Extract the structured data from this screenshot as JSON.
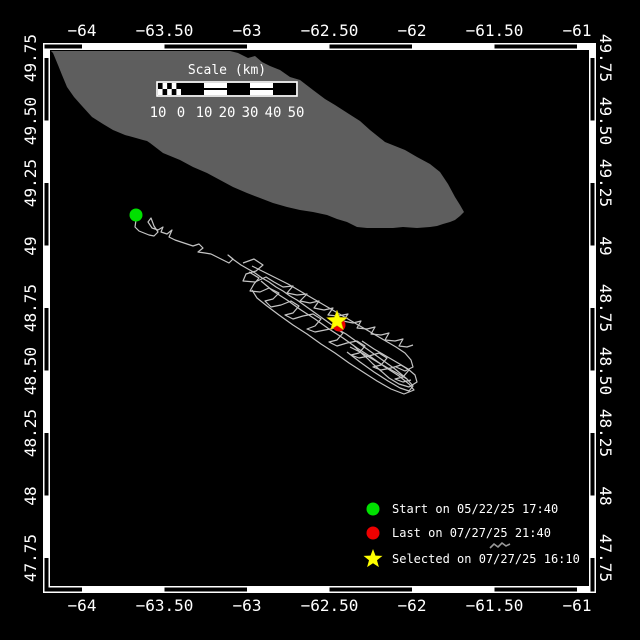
{
  "colors": {
    "background": "#000000",
    "frame": "#ffffff",
    "land": "#5e5e5e",
    "track": "#c4c4c4",
    "islet": "#9a9a9a",
    "start": "#00e000",
    "last": "#ee0000",
    "selected": "#ffff00",
    "text": "#ffffff"
  },
  "axes": {
    "x_ticks": [
      {
        "label": "−64",
        "lon": -64
      },
      {
        "label": "−63.50",
        "lon": -63.5
      },
      {
        "label": "−63",
        "lon": -63
      },
      {
        "label": "−62.50",
        "lon": -62.5
      },
      {
        "label": "−62",
        "lon": -62
      },
      {
        "label": "−61.50",
        "lon": -61.5
      },
      {
        "label": "−61",
        "lon": -61
      }
    ],
    "y_ticks": [
      {
        "label": "49.75",
        "lat": 49.75
      },
      {
        "label": "49.50",
        "lat": 49.5
      },
      {
        "label": "49.25",
        "lat": 49.25
      },
      {
        "label": "49",
        "lat": 49.0
      },
      {
        "label": "48.75",
        "lat": 48.75
      },
      {
        "label": "48.50",
        "lat": 48.5
      },
      {
        "label": "48.25",
        "lat": 48.25
      },
      {
        "label": "48",
        "lat": 48.0
      },
      {
        "label": "47.75",
        "lat": 47.75
      }
    ]
  },
  "scalebar": {
    "title": "Scale (km)",
    "tick_labels": [
      "10",
      "0",
      "10",
      "20",
      "30",
      "40",
      "50"
    ],
    "km_per_segment": 10
  },
  "legend": [
    {
      "symbol": "circle",
      "color": "#00e000",
      "label": "Start on 05/22/25 17:40"
    },
    {
      "symbol": "circle",
      "color": "#ee0000",
      "label": "Last on 07/27/25 21:40"
    },
    {
      "symbol": "star",
      "color": "#ffff00",
      "label": "Selected on 07/27/25 16:10"
    }
  ],
  "markers": {
    "start": {
      "x": 136,
      "y": 215,
      "r": 6.5,
      "lon": -63.67,
      "lat": 49.12
    },
    "last": {
      "x": 339,
      "y": 325,
      "r": 6.5,
      "lon": -62.45,
      "lat": 48.68
    },
    "selected": {
      "x": 337,
      "y": 321,
      "r": 11,
      "lon": -62.46,
      "lat": 48.7
    }
  },
  "map": {
    "lon_range": [
      -64.25,
      -60.93
    ],
    "lat_range": [
      47.63,
      49.79
    ],
    "land_polygon": [
      [
        51,
        51
      ],
      [
        230,
        51
      ],
      [
        238,
        53
      ],
      [
        248,
        58
      ],
      [
        255,
        56
      ],
      [
        262,
        62
      ],
      [
        270,
        66
      ],
      [
        280,
        70
      ],
      [
        290,
        77
      ],
      [
        300,
        80
      ],
      [
        313,
        90
      ],
      [
        325,
        99
      ],
      [
        335,
        105
      ],
      [
        349,
        114
      ],
      [
        360,
        121
      ],
      [
        370,
        130
      ],
      [
        385,
        142
      ],
      [
        395,
        146
      ],
      [
        405,
        150
      ],
      [
        417,
        157
      ],
      [
        430,
        164
      ],
      [
        440,
        172
      ],
      [
        448,
        184
      ],
      [
        455,
        197
      ],
      [
        460,
        205
      ],
      [
        464,
        212
      ],
      [
        460,
        216
      ],
      [
        455,
        220
      ],
      [
        450,
        222
      ],
      [
        443,
        224
      ],
      [
        437,
        226
      ],
      [
        430,
        227
      ],
      [
        417,
        228
      ],
      [
        403,
        227
      ],
      [
        393,
        228
      ],
      [
        380,
        228
      ],
      [
        367,
        228
      ],
      [
        357,
        227
      ],
      [
        347,
        222
      ],
      [
        337,
        219
      ],
      [
        327,
        215
      ],
      [
        313,
        212
      ],
      [
        300,
        210
      ],
      [
        287,
        207
      ],
      [
        273,
        203
      ],
      [
        260,
        198
      ],
      [
        247,
        193
      ],
      [
        233,
        187
      ],
      [
        220,
        180
      ],
      [
        207,
        173
      ],
      [
        193,
        167
      ],
      [
        180,
        160
      ],
      [
        163,
        153
      ],
      [
        150,
        143
      ],
      [
        147,
        141
      ],
      [
        143,
        140
      ],
      [
        136,
        138
      ],
      [
        125,
        135
      ],
      [
        113,
        130
      ],
      [
        103,
        124
      ],
      [
        92,
        117
      ],
      [
        82,
        106
      ],
      [
        74,
        97
      ],
      [
        67,
        87
      ],
      [
        62,
        75
      ],
      [
        58,
        65
      ],
      [
        53,
        53
      ]
    ],
    "islet_path": [
      [
        490,
        548
      ],
      [
        494,
        544
      ],
      [
        498,
        547
      ],
      [
        502,
        543
      ],
      [
        506,
        546
      ],
      [
        510,
        544
      ]
    ]
  },
  "track": {
    "segments": [
      [
        136,
        220,
        135,
        227,
        139,
        231,
        144,
        233,
        149,
        235,
        154,
        236,
        158,
        232,
        154,
        226,
        151,
        218,
        148,
        222,
        152,
        228,
        158,
        230,
        163,
        227,
        161,
        232,
        167,
        234,
        172,
        230,
        169,
        237,
        175,
        240,
        181,
        242,
        187,
        244,
        193,
        246,
        199,
        244,
        203,
        248,
        198,
        252,
        205,
        253,
        211,
        254,
        217,
        257,
        223,
        260,
        229,
        263,
        233,
        259,
        228,
        255,
        234,
        260,
        241,
        265,
        248,
        269,
        255,
        273,
        262,
        278,
        269,
        282,
        276,
        287,
        283,
        291,
        290,
        296,
        297,
        300,
        304,
        305,
        311,
        310,
        318,
        315,
        325,
        320,
        332,
        325,
        339,
        330,
        346,
        334,
        353,
        339,
        360,
        344,
        367,
        349,
        374,
        354,
        381,
        359,
        388,
        364,
        395,
        369,
        401,
        374,
        407,
        379
      ],
      [
        243,
        263,
        254,
        259,
        263,
        265,
        256,
        271,
        246,
        274,
        243,
        281,
        255,
        282,
        266,
        277,
        274,
        282,
        283,
        287,
        293,
        286,
        287,
        293,
        297,
        295,
        307,
        294,
        300,
        301,
        310,
        303,
        319,
        301,
        314,
        308,
        324,
        310,
        333,
        308,
        328,
        315,
        338,
        316,
        348,
        314,
        343,
        321,
        353,
        323,
        361,
        321,
        357,
        328,
        367,
        329,
        375,
        327,
        371,
        334,
        381,
        335,
        389,
        333,
        385,
        340,
        395,
        341,
        403,
        339,
        399,
        346,
        407,
        347,
        413,
        345
      ],
      [
        249,
        272,
        259,
        278,
        254,
        284,
        250,
        291,
        260,
        292,
        269,
        288,
        279,
        293,
        273,
        299,
        265,
        301,
        271,
        307,
        281,
        305,
        291,
        301,
        299,
        306,
        293,
        313,
        285,
        315,
        293,
        319,
        303,
        316,
        313,
        314,
        321,
        319,
        315,
        326,
        307,
        329,
        315,
        332,
        325,
        330,
        335,
        328,
        343,
        333,
        337,
        340,
        329,
        342,
        337,
        346,
        347,
        343,
        357,
        341,
        365,
        346,
        359,
        353,
        351,
        355,
        359,
        358,
        369,
        356,
        379,
        353,
        387,
        358,
        381,
        365,
        373,
        367,
        381,
        370,
        391,
        368,
        401,
        365,
        409,
        370,
        403,
        377,
        395,
        379,
        403,
        382,
        411,
        380
      ],
      [
        261,
        281,
        273,
        291,
        287,
        300,
        301,
        310,
        315,
        319,
        329,
        329,
        343,
        338,
        357,
        348,
        371,
        357,
        385,
        367,
        399,
        376,
        409,
        384,
        414,
        390,
        404,
        394,
        391,
        389,
        377,
        381,
        363,
        372,
        349,
        363,
        335,
        353,
        321,
        344,
        307,
        334,
        293,
        325,
        279,
        315,
        267,
        306,
        257,
        298,
        252,
        290
      ],
      [
        362,
        341,
        374,
        349,
        386,
        356,
        398,
        363,
        408,
        369,
        415,
        375,
        417,
        382,
        409,
        387,
        399,
        384,
        389,
        378,
        381,
        371,
        373,
        364,
        367,
        358,
        359,
        351,
        353,
        345
      ],
      [
        347,
        352,
        360,
        362,
        374,
        372,
        388,
        381,
        400,
        388,
        409,
        391,
        413,
        386,
        407,
        379,
        397,
        373,
        386,
        367,
        374,
        360,
        362,
        353,
        350,
        347
      ],
      [
        252,
        266,
        264,
        272,
        276,
        278,
        288,
        284,
        300,
        291,
        312,
        298,
        324,
        305,
        336,
        312,
        348,
        319,
        360,
        326,
        372,
        333,
        384,
        340,
        396,
        347,
        405,
        353,
        411,
        360,
        413,
        367,
        405,
        371,
        396,
        367
      ]
    ]
  },
  "chart_data": {
    "type": "map-track",
    "title": "",
    "xlabel": "longitude (deg)",
    "ylabel": "latitude (deg)",
    "lon_ticks": [
      -64,
      -63.5,
      -63,
      -62.5,
      -62,
      -61.5,
      -61
    ],
    "lat_ticks": [
      49.75,
      49.5,
      49.25,
      49,
      48.75,
      48.5,
      48.25,
      48,
      47.75
    ],
    "events": [
      {
        "name": "Start",
        "date": "05/22/25 17:40",
        "lon": -63.67,
        "lat": 49.12
      },
      {
        "name": "Last",
        "date": "07/27/25 21:40",
        "lon": -62.45,
        "lat": 48.68
      },
      {
        "name": "Selected",
        "date": "07/27/25 16:10",
        "lon": -62.46,
        "lat": 48.7
      }
    ]
  }
}
